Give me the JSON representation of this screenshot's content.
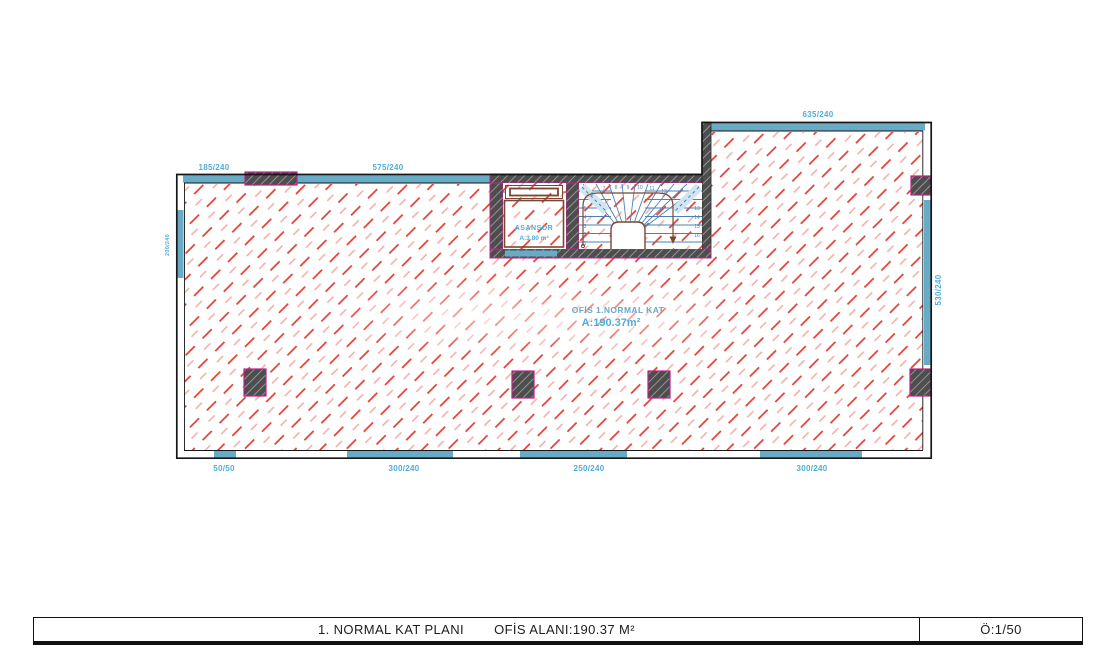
{
  "titlebar": {
    "title": "1. NORMAL KAT PLANI",
    "area": "OFİS ALANI:190.37 M²",
    "scale": "Ö:1/50"
  },
  "plan": {
    "room_label": {
      "name": "OFİS 1.NORMAL KAT",
      "area": "A:190.37m²"
    },
    "elevator": {
      "name": "ASANSÖR",
      "area": "A:3.80 m²"
    },
    "dims": {
      "top_left": "185/240",
      "top_mid": "575/240",
      "top_right": "635/240",
      "right": "530/240",
      "left": "200/240",
      "bottom": [
        "50/50",
        "300/240",
        "250/240",
        "300/240"
      ]
    },
    "stair": {
      "steps": [
        "1",
        "2",
        "3",
        "4",
        "5",
        "6",
        "7",
        "8",
        "9",
        "10",
        "11",
        "12",
        "13",
        "14",
        "15",
        "16"
      ]
    },
    "colors": {
      "hatch_red": "#e23b2e",
      "hatch_pink": "#f2aca4",
      "window_blue": "#67abc7",
      "label_blue": "#4fadda",
      "room_name_blue": "#6ba7c9",
      "wall_gray": "#4d4d4d",
      "magenta": "#bf1f8a",
      "stair_blue": "#4a82b8",
      "walkline_brown": "#7b4631"
    }
  }
}
